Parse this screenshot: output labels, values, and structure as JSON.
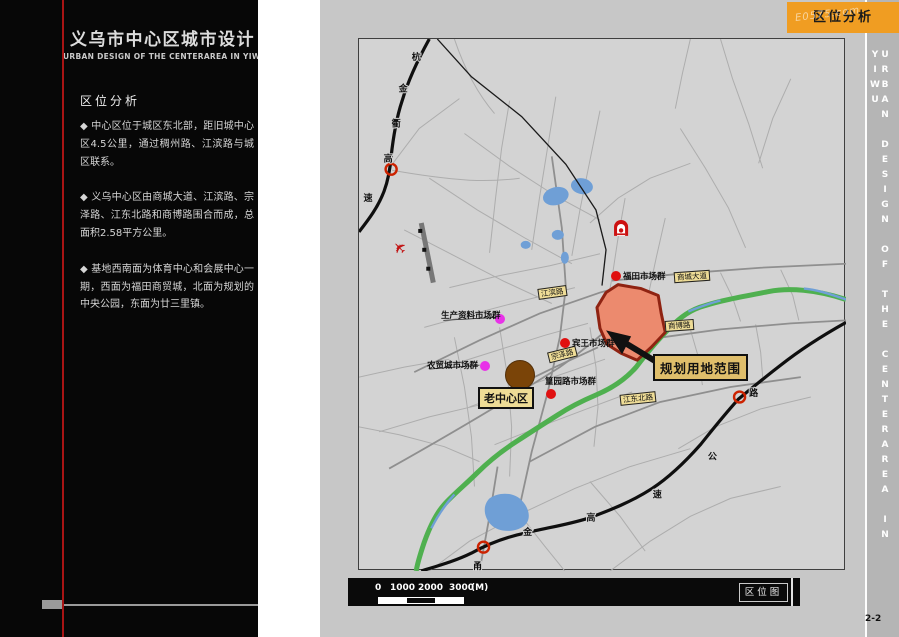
{
  "header": {
    "tab_label": "区位分析",
    "watermark": "E0575.com"
  },
  "sidebar": {
    "title_cn": "义乌市中心区城市设计",
    "title_en": "URBAN DESIGN OF THE CENTERAREA IN YIWU",
    "section_title": "区位分析",
    "bullets": [
      "◆ 中心区位于城区东北部，距旧城中心区4.5公里，通过稠州路、江滨路与城区联系。",
      "◆ 义乌中心区由商城大道、江滨路、宗泽路、江东北路和商博路围合而成，总面积2.58平方公里。",
      "◆ 基地西南面为体育中心和会展中心一期，西面为福田商贸城，北面为规划的中央公园，东面为廿三里镇。"
    ]
  },
  "side_strip": {
    "vertical_text": "URBAN DESIGN OF THE CENTERAREA IN YIWU",
    "page_number": "2-2"
  },
  "map": {
    "caption": "区位图",
    "scale_labels": [
      "0",
      "1000",
      "2000",
      "3000",
      "(M)"
    ],
    "road_labels": {
      "jiangbin": "江滨路",
      "shangcheng": "商城大道",
      "shangbo": "商博路",
      "zongze": "宗泽路",
      "jiangdongbei": "江东北路"
    },
    "planning_area_label": "规划用地范围",
    "old_center_label": "老中心区",
    "markets": [
      {
        "name": "福田市场群",
        "dot": "red"
      },
      {
        "name": "生产资料市场群",
        "dot": "magenta"
      },
      {
        "name": "宾王市场群",
        "dot": "red"
      },
      {
        "name": "农贸城市场群",
        "dot": "magenta"
      },
      {
        "name": "篁园路市场群",
        "dot": "red"
      }
    ],
    "highway_left_name": "杭金衢高速",
    "highway_left_chars": [
      "杭",
      "金",
      "衢",
      "高",
      "速"
    ],
    "highway_bottom_name": "甬金高速公路",
    "highway_bottom_chars": [
      "甬",
      "金",
      "高",
      "速",
      "公",
      "路"
    ],
    "colors": {
      "planning_fill": "#ec8a6e",
      "planning_border": "#8f2312",
      "accent_orange": "#f09d22",
      "label_yellow": "#eedc96",
      "river_green": "#4fb04f",
      "water_blue": "#6f9fd6",
      "dot_red": "#e01010",
      "dot_magenta": "#e832e8",
      "old_center_brown": "#7a4408"
    }
  }
}
